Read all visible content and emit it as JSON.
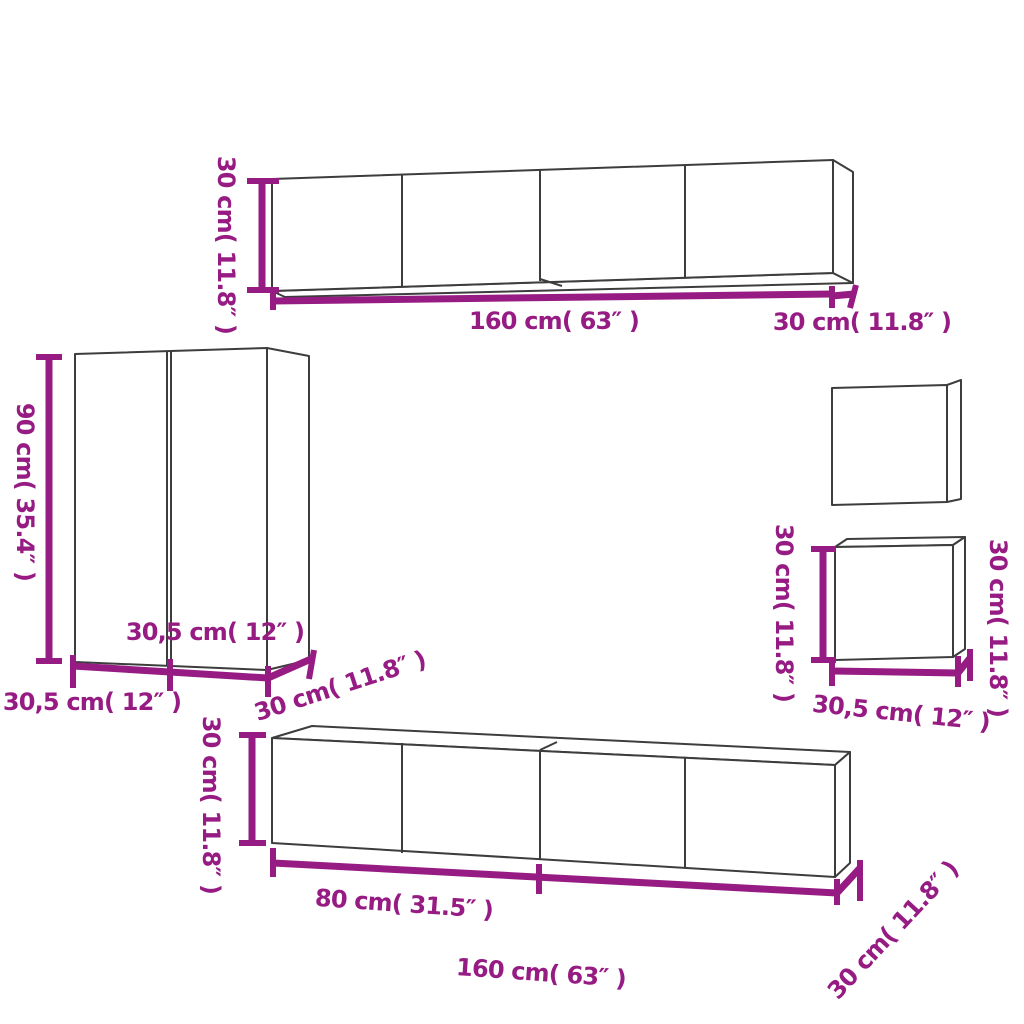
{
  "colors": {
    "background": "#ffffff",
    "outline": "#3d3d3d",
    "dimension": "#961b83"
  },
  "labels": {
    "top_cabinet": {
      "height": "30 cm( 11.8″ )",
      "width": "160 cm( 63″ )",
      "depth": "30 cm( 11.8″ )"
    },
    "tall_cabinet": {
      "height": "90 cm( 35.4″ )",
      "door_width": "30,5 cm( 12″ )",
      "width": "30,5 cm( 12″ )",
      "depth": "30 cm( 11.8″ )"
    },
    "small_cabinet": {
      "height_left": "30 cm( 11.8″ )",
      "height_right": "30 cm( 11.8″ )",
      "width": "30,5 cm( 12″ )"
    },
    "bottom_cabinet": {
      "height": "30 cm( 11.8″ )",
      "section_width": "80 cm( 31.5″ )",
      "width": "160 cm( 63″ )",
      "depth": "30 cm( 11.8″ )"
    }
  }
}
